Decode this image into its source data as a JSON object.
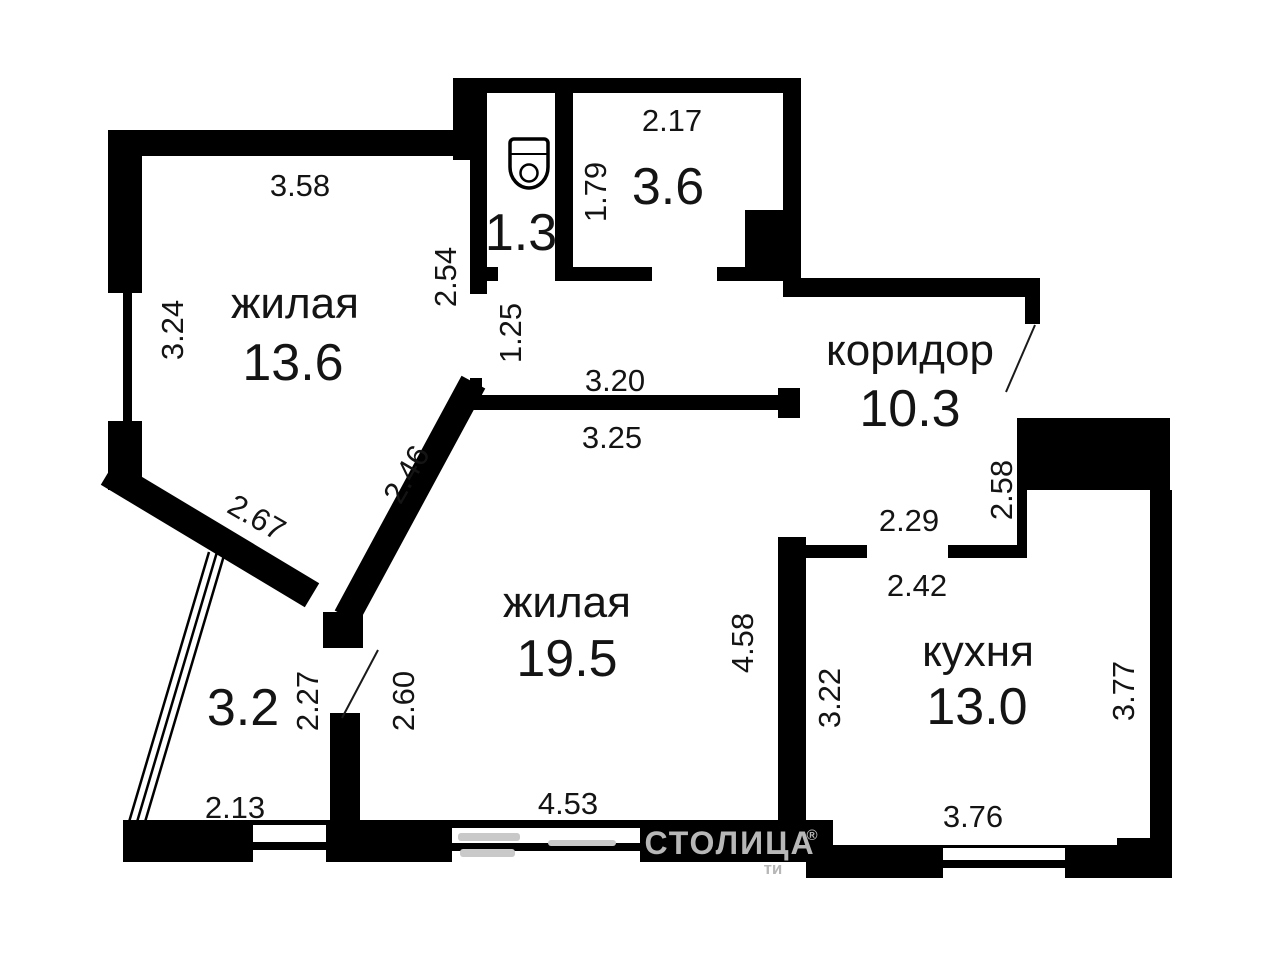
{
  "plan": {
    "rooms": {
      "living1": {
        "label": "жилая",
        "area": "13.6"
      },
      "wc": {
        "area": "1.3"
      },
      "pantry": {
        "area": "3.6"
      },
      "hall": {
        "label": "коридор",
        "area": "10.3"
      },
      "living2": {
        "label": "жилая",
        "area": "19.5"
      },
      "kitchen": {
        "label": "кухня",
        "area": "13.0"
      },
      "balcony": {
        "area": "3.2"
      }
    },
    "dimensions": {
      "room1_top": "3.58",
      "room1_left": "3.24",
      "room1_right": "2.54",
      "passage": "1.25",
      "pantry_top": "2.17",
      "pantry_left": "1.79",
      "hall_top": "3.20",
      "room2_top": "3.25",
      "diag_upper": "2.46",
      "diag_lower": "2.67",
      "room2_right": "4.58",
      "hall_bottom": "2.29",
      "hall_right": "2.58",
      "kitchen_top": "2.42",
      "kitchen_left": "3.22",
      "kitchen_right": "3.77",
      "kitchen_bottom": "3.76",
      "balcony_inner": "2.27",
      "balcony_door": "2.60",
      "balcony_bottom": "2.13",
      "room2_bottom": "4.53"
    }
  },
  "watermark": {
    "brand": "СТОЛИЦА",
    "registered": "®",
    "fragment": "ти"
  }
}
